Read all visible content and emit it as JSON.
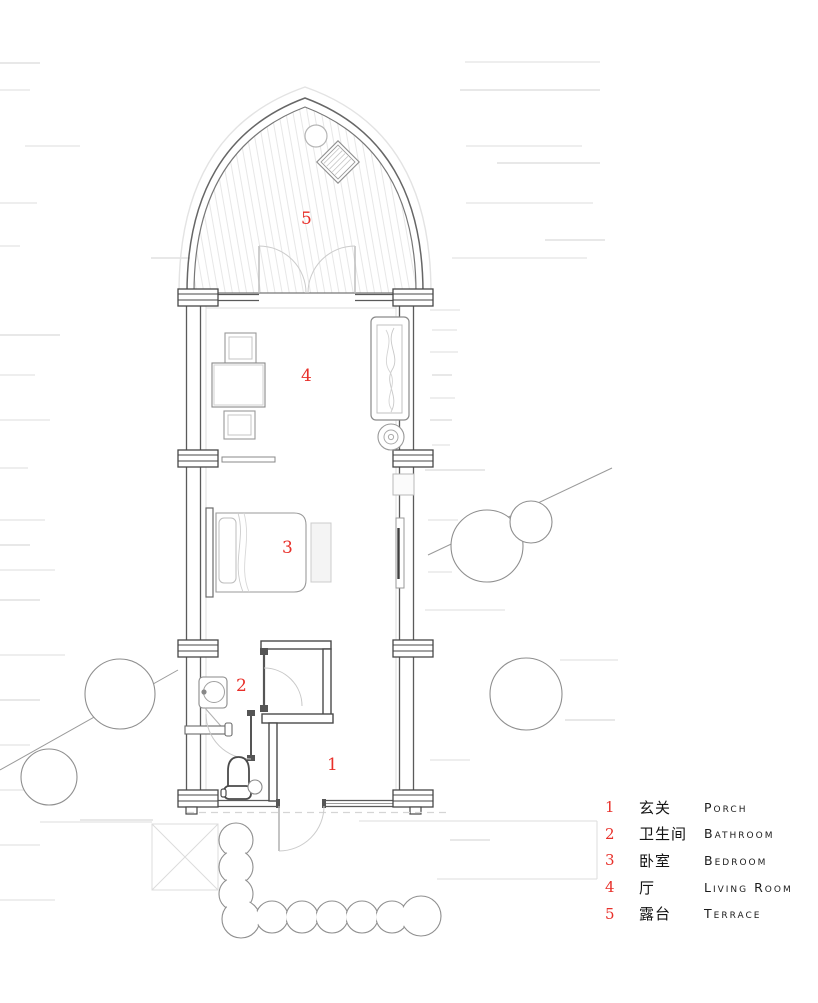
{
  "plan": {
    "room_numbers": {
      "porch": "1",
      "bathroom": "2",
      "bedroom": "3",
      "living_room": "4",
      "terrace": "5"
    }
  },
  "legend": {
    "items": [
      {
        "num": "1",
        "zh": "玄关",
        "en": "Porch"
      },
      {
        "num": "2",
        "zh": "卫生间",
        "en": "Bathroom"
      },
      {
        "num": "3",
        "zh": "卧室",
        "en": "Bedroom"
      },
      {
        "num": "4",
        "zh": "厅",
        "en": "Living Room"
      },
      {
        "num": "5",
        "zh": "露台",
        "en": "Terrace"
      }
    ]
  },
  "colors": {
    "accent_red": "#e8302a",
    "wall_dark": "#4a4a4a",
    "line_mid": "#8f8f8f",
    "line_light": "#d8d8d8"
  }
}
